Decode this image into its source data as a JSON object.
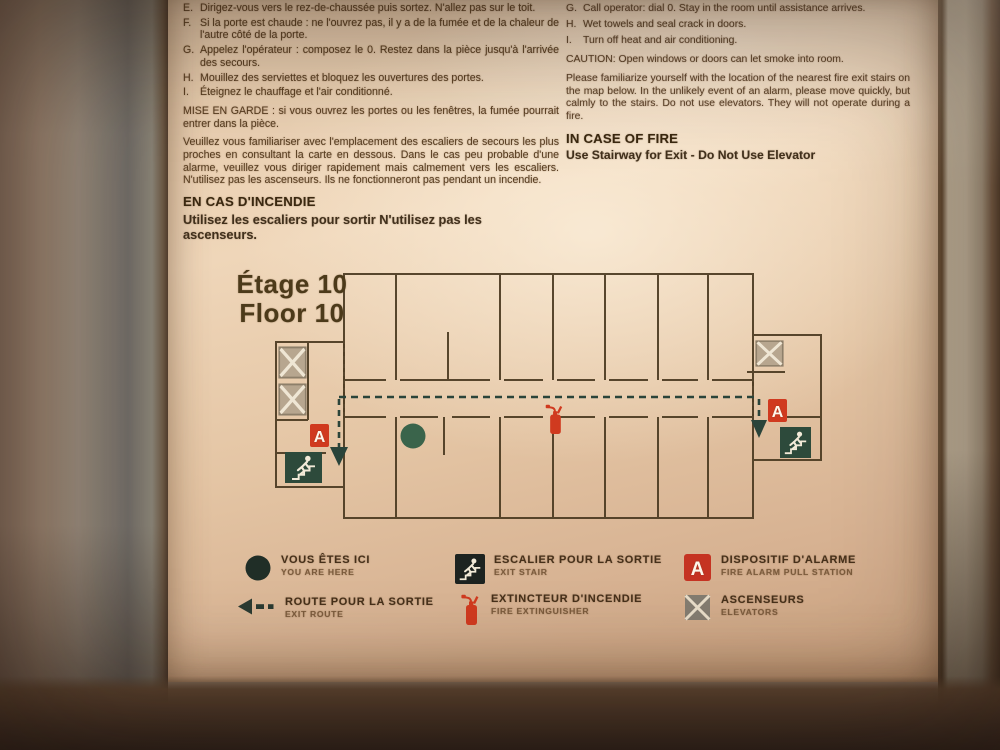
{
  "sign": {
    "alarm_letter": "A",
    "french_instructions": {
      "items": [
        {
          "letter": "E.",
          "text": "Dirigez-vous vers le rez-de-chaussée puis sortez. N'allez pas sur le toit."
        },
        {
          "letter": "F.",
          "text": "Si la porte est chaude : ne l'ouvrez pas, il y a de la fumée et de la chaleur de l'autre côté de la porte."
        },
        {
          "letter": "G.",
          "text": "Appelez l'opérateur : composez le 0. Restez dans la pièce jusqu'à l'arrivée des secours."
        },
        {
          "letter": "H.",
          "text": "Mouillez des serviettes et bloquez les ouvertures des portes."
        },
        {
          "letter": "I.",
          "text": "Éteignez le chauffage et l'air conditionné."
        }
      ],
      "warning": "MISE EN GARDE : si vous ouvrez les portes ou les fenêtres, la fumée pourrait entrer dans la pièce.",
      "paragraph": "Veuillez vous familiariser avec l'emplacement des escaliers de secours les plus proches en consultant la carte en dessous. Dans le cas peu probable d'une alarme, veuillez vous diriger rapidement mais calmement vers les escaliers. N'utilisez pas les ascenseurs. Ils ne fonctionneront pas pendant un incendie.",
      "heading": "EN CAS D'INCENDIE",
      "subheading": "Utilisez les escaliers pour sortir  N'utilisez pas les ascenseurs."
    },
    "english_instructions": {
      "items": [
        {
          "letter": "G.",
          "text": "Call operator: dial 0. Stay in the room until assistance arrives."
        },
        {
          "letter": "H.",
          "text": "Wet towels and seal crack in doors."
        },
        {
          "letter": "I.",
          "text": "Turn off heat and air conditioning."
        }
      ],
      "caution": "CAUTION: Open windows or doors can let smoke into room.",
      "paragraph": "Please familiarize yourself with the location of the nearest fire exit stairs on the map below. In the unlikely event of an alarm, please move quickly, but calmly to the stairs. Do not use elevators. They will not operate during a fire.",
      "heading": "IN CASE OF FIRE",
      "subheading": "Use Stairway for Exit - Do Not Use Elevator"
    },
    "floor_plan": {
      "title_fr": "Étage 10",
      "title_en": "Floor 10"
    },
    "legend": {
      "items": [
        {
          "id": "you-are-here",
          "label_fr": "VOUS ÊTES ICI",
          "label_en": "YOU ARE HERE"
        },
        {
          "id": "exit-route",
          "label_fr": "ROUTE POUR LA SORTIE",
          "label_en": "EXIT ROUTE"
        },
        {
          "id": "exit-stair",
          "label_fr": "ESCALIER POUR LA SORTIE",
          "label_en": "EXIT STAIR"
        },
        {
          "id": "fire-extinguisher",
          "label_fr": "EXTINCTEUR D'INCENDIE",
          "label_en": "FIRE EXTINGUISHER"
        },
        {
          "id": "fire-alarm",
          "label_fr": "DISPOSITIF D'ALARME",
          "label_en": "FIRE ALARM PULL STATION"
        },
        {
          "id": "elevators",
          "label_fr": "ASCENSEURS",
          "label_en": "ELEVATORS"
        }
      ]
    },
    "colors": {
      "paper": "#ecd2b4",
      "ink": "#583d20",
      "heading_ink": "#3a2810",
      "map_wall": "#4b3a21",
      "route_green": "#2a443a",
      "alarm_red": "#d03a1f",
      "exit_green": "#2d4a3b",
      "elevator_tan": "#b7a68f",
      "legend_black": "#1d2320"
    }
  }
}
